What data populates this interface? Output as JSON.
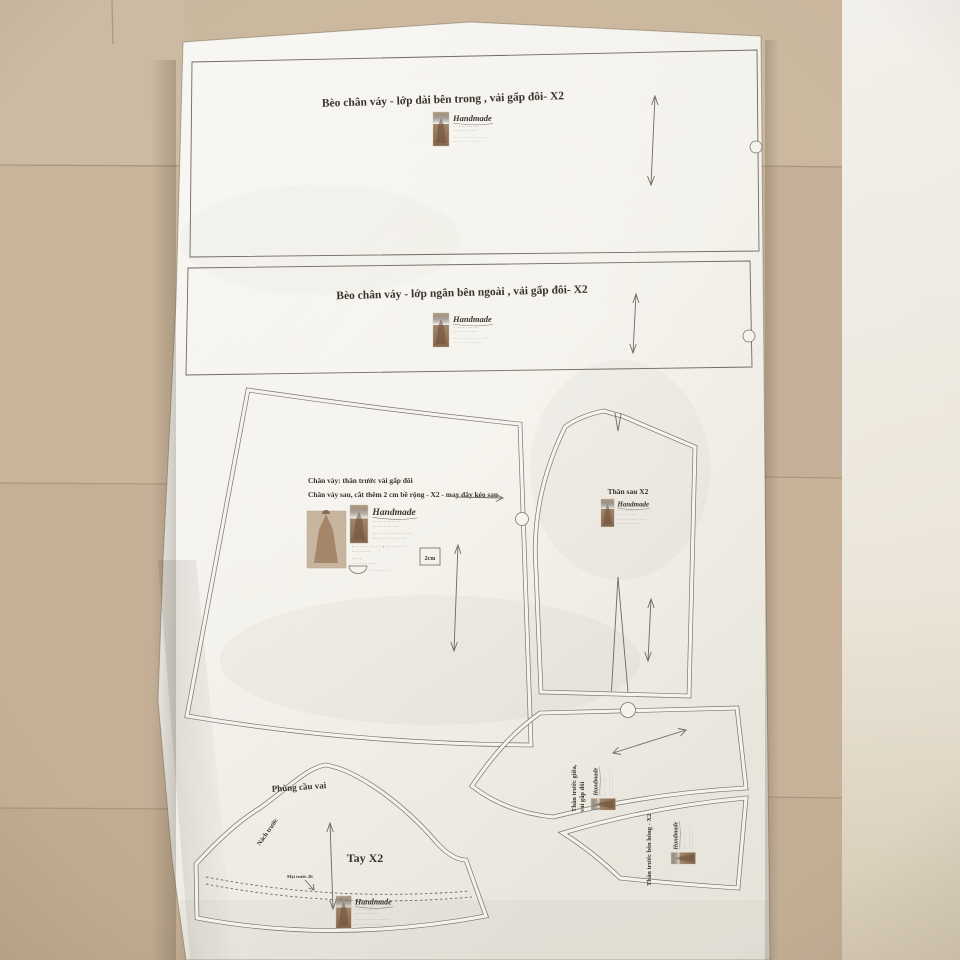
{
  "photo": {
    "floor_color": "#c9b69b",
    "paper_color": "#f7f5f0",
    "line_color": "#6f6a64",
    "accent_red": "#a63528"
  },
  "pieces": {
    "ruffle_long": {
      "title": "Bèo chân váy - lớp dài bên trong , vải gấp đôi-  X2"
    },
    "ruffle_short": {
      "title": "Bèo chân váy - lớp ngắn bên ngoài , vải gấp đôi-  X2"
    },
    "skirt": {
      "note_line1": "Chân váy: thân trước vải gấp đôi",
      "note_line2": "Chân váy sau, cắt thêm 2 cm bề rộng - X2  - may dây kéo sau",
      "scale_label": "2cm"
    },
    "bodice_back": {
      "label": "Thân sau X2"
    },
    "sleeve": {
      "label": "Tay X2",
      "cap_label": "Phùng cầu vai",
      "armhole_label": "Nách trước",
      "hem_note": "Mặt trước 2li"
    },
    "front_center": {
      "label_1": "Thân trước giữa,",
      "label_2": "vải gấp đôi"
    },
    "front_side": {
      "label": "Thân trước bên hông - X2"
    }
  },
  "watermark": {
    "script": "Handmade",
    "line_red": "·· ···· ··· ····· ····",
    "line_dark": "···· ··· ·· ··· ·····",
    "addr1": "··· ···· ·· ··· ····· ·· ···· ···",
    "addr2": "···· ·· ·· ·· ·· ·· ··· ····"
  },
  "fine_print": {
    "b1": "- ····· ··· :",
    "b2": "- ··· ··· ·· - ··· ··· ·· + ···· · ······ ···",
    "b3": "- ··· ··· ·····",
    "b4": "- ·· · :",
    "b5": "··· ·· ··· ····· ···",
    "b6": "·· ··· ·· ··· ··"
  }
}
